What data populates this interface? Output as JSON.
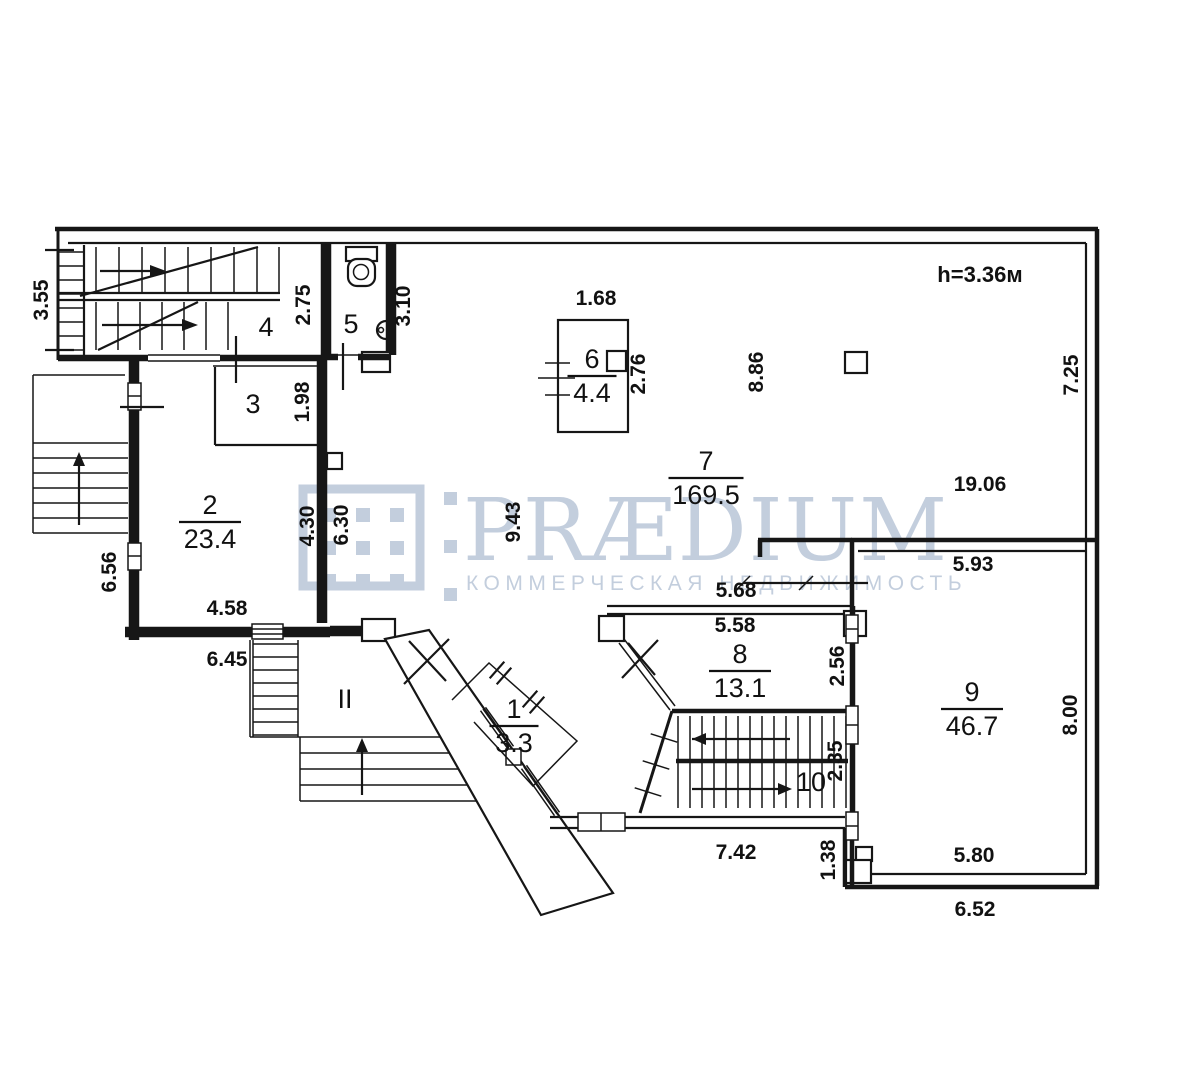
{
  "watermark": {
    "brand": "PRÆDIUM",
    "tagline": "КОММЕРЧЕСКАЯ НЕДВИЖИМОСТЬ",
    "color": "#b9c6d8"
  },
  "plan": {
    "height_note": "h=3.36м",
    "rooms": [
      {
        "number": "1",
        "area": "3.3",
        "x": 514,
        "y": 718
      },
      {
        "number": "2",
        "area": "23.4",
        "x": 210,
        "y": 514
      },
      {
        "number": "3",
        "area": null,
        "x": 253,
        "y": 413
      },
      {
        "number": "4",
        "area": null,
        "x": 266,
        "y": 336
      },
      {
        "number": "5",
        "area": null,
        "x": 351,
        "y": 333
      },
      {
        "number": "6",
        "area": "4.4",
        "x": 592,
        "y": 368
      },
      {
        "number": "7",
        "area": "169.5",
        "x": 706,
        "y": 470
      },
      {
        "number": "8",
        "area": "13.1",
        "x": 740,
        "y": 663
      },
      {
        "number": "9",
        "area": "46.7",
        "x": 972,
        "y": 701
      },
      {
        "number": "10",
        "area": null,
        "x": 811,
        "y": 791
      },
      {
        "number": "II",
        "area": null,
        "x": 345,
        "y": 708
      }
    ],
    "dimensions": [
      {
        "text": "3.55",
        "x": 48,
        "y": 300,
        "rot": -90
      },
      {
        "text": "2.75",
        "x": 310,
        "y": 305,
        "rot": -90
      },
      {
        "text": "3.10",
        "x": 410,
        "y": 306,
        "rot": -90
      },
      {
        "text": "1.98",
        "x": 309,
        "y": 402,
        "rot": -90
      },
      {
        "text": "1.68",
        "x": 596,
        "y": 305,
        "rot": 0
      },
      {
        "text": "2.76",
        "x": 645,
        "y": 374,
        "rot": -90
      },
      {
        "text": "8.86",
        "x": 763,
        "y": 372,
        "rot": -90
      },
      {
        "text": "7.25",
        "x": 1078,
        "y": 375,
        "rot": -90
      },
      {
        "text": "19.06",
        "x": 980,
        "y": 491,
        "rot": 0
      },
      {
        "text": "9.43",
        "x": 520,
        "y": 522,
        "rot": -90
      },
      {
        "text": "4.30",
        "x": 314,
        "y": 526,
        "rot": -90
      },
      {
        "text": "6.30",
        "x": 348,
        "y": 525,
        "rot": -90
      },
      {
        "text": "6.56",
        "x": 116,
        "y": 572,
        "rot": -90
      },
      {
        "text": "4.58",
        "x": 227,
        "y": 615,
        "rot": 0
      },
      {
        "text": "6.45",
        "x": 227,
        "y": 666,
        "rot": 0
      },
      {
        "text": "5.93",
        "x": 973,
        "y": 571,
        "rot": 0
      },
      {
        "text": "5.68",
        "x": 736,
        "y": 597,
        "rot": 0
      },
      {
        "text": "5.58",
        "x": 735,
        "y": 632,
        "rot": 0
      },
      {
        "text": "2.56",
        "x": 844,
        "y": 666,
        "rot": -90
      },
      {
        "text": "8.00",
        "x": 1077,
        "y": 715,
        "rot": -90
      },
      {
        "text": "2.35",
        "x": 842,
        "y": 761,
        "rot": -90
      },
      {
        "text": "7.42",
        "x": 736,
        "y": 859,
        "rot": 0
      },
      {
        "text": "1.38",
        "x": 835,
        "y": 860,
        "rot": -90
      },
      {
        "text": "5.80",
        "x": 974,
        "y": 862,
        "rot": 0
      },
      {
        "text": "6.52",
        "x": 975,
        "y": 916,
        "rot": 0
      }
    ]
  }
}
